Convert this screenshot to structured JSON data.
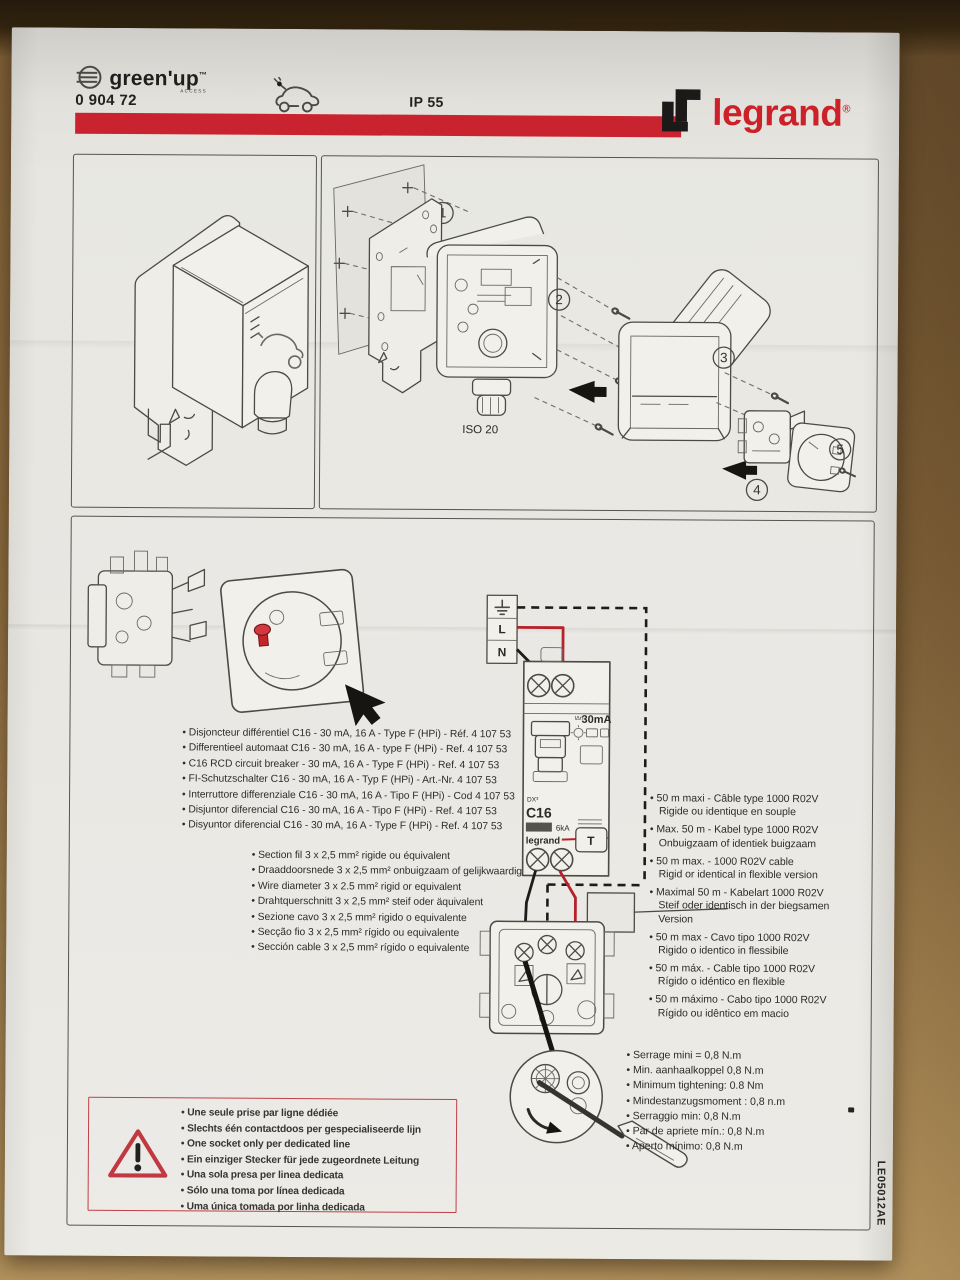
{
  "header": {
    "logo_text": "green'up",
    "logo_tm": "™",
    "logo_sub": "ACCESS",
    "product_ref": "0 904 72",
    "ip_rating": "IP 55",
    "brand": "legrand",
    "brand_reg": "®",
    "accent_red": "#c8232e"
  },
  "exploded": {
    "steps": [
      "1",
      "2",
      "3",
      "4",
      "5"
    ],
    "iso_label": "ISO 20"
  },
  "wiring": {
    "earth_label": "",
    "line_label": "L",
    "neutral_label": "N",
    "breaker": {
      "idn": "IΔn",
      "sensitivity": "30mA",
      "model": "DX³",
      "curve": "C16",
      "breaking": "6kA",
      "brand": "legrand",
      "test": "T"
    },
    "wire_colors": {
      "phase": "#b5232a",
      "neutral": "#1d1c1a"
    }
  },
  "lists": {
    "breaker": [
      "Disjoncteur différentiel C16 - 30 mA, 16 A - Type F (HPi) - Réf. 4 107 53",
      "Differentieel automaat C16 - 30 mA, 16 A - type F (HPi) - Ref. 4 107 53",
      "C16 RCD circuit breaker - 30 mA, 16 A - Type F (HPi) - Ref. 4 107 53",
      "FI-Schutzschalter C16 - 30 mA, 16 A - Typ F (HPi) - Art.-Nr. 4 107 53",
      "Interruttore differenziale C16 - 30 mA, 16 A - Tipo F (HPi) - Cod 4 107 53",
      "Disjuntor diferencial C16 - 30 mA, 16 A - Tipo F (HPi) - Ref. 4 107 53",
      "Disyuntor diferencial C16 - 30 mA, 16 A - Type F (HPi) - Ref. 4 107 53"
    ],
    "wire": [
      "Section fil 3 x 2,5 mm² rigide ou équivalent",
      "Draaddoorsnede 3 x 2,5 mm² onbuigzaam of gelijkwaardig",
      "Wire diameter 3 x 2.5 mm² rigid or equivalent",
      "Drahtquerschnitt 3 x 2,5 mm² steif oder äquivalent",
      "Sezione cavo 3 x 2,5 mm² rigido o equivalente",
      "Secção fio 3 x 2,5 mm² rígido ou equivalente",
      "Sección cable 3 x 2,5 mm² rígido o equivalente"
    ],
    "cable": [
      "50 m maxi - Câble type 1000 R02V\nRigide ou identique en souple",
      "Max. 50 m - Kabel type 1000 R02V\nOnbuigzaam of identiek buigzaam",
      "50 m max. - 1000 R02V cable\nRigid or identical in flexible version",
      "Maximal 50 m - Kabelart 1000 R02V\nSteif oder identisch in der biegsamen\nVersion",
      "50 m max - Cavo tipo 1000 R02V\nRigido o identico in flessibile",
      "50 m máx. - Cable tipo 1000 R02V\nRígido o idéntico en flexible",
      "50 m máximo - Cabo tipo 1000 R02V\nRígido ou idêntico em macio"
    ],
    "torque": [
      "Serrage mini = 0,8 N.m",
      "Min. aanhaalkoppel 0,8 N.m",
      "Minimum tightening: 0.8 Nm",
      "Mindestanzugsmoment : 0,8 n.m",
      "Serraggio min: 0,8 N.m",
      "Par de apriete mín.: 0,8 N.m",
      "Aperto mínimo: 0,8 N.m"
    ],
    "warning": [
      "Une seule prise par ligne dédiée",
      "Slechts één contactdoos per gespecialiseerde lijn",
      "One socket only per dedicated line",
      "Ein einziger Stecker für jede zugeordnete Leitung",
      "Una sola presa per linea dedicata",
      "Sólo una toma por línea dedicada",
      "Uma única tomada por linha dedicada"
    ]
  },
  "doc_code": "LE05012AE"
}
